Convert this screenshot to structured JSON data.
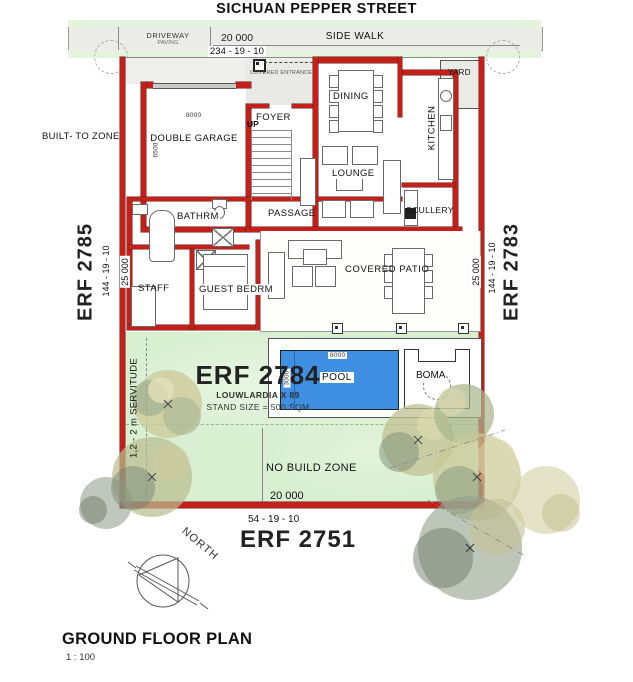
{
  "street": {
    "name": "SICHUAN PEPPER STREET"
  },
  "top_band": {
    "driveway": "DRIVEWAY",
    "driveway_sub": "PAVING",
    "sidewalk": "SIDE WALK",
    "width_dim": "20 000",
    "bearing": "234 - 19 - 10",
    "covered_entrance": "COVERED ENTRANCE"
  },
  "left": {
    "built_to_zone": "BUILT- TO ZONE",
    "erf": "ERF 2785",
    "bearing": "144 - 19 - 10",
    "dim": "25 000"
  },
  "right": {
    "erf": "ERF 2783",
    "bearing": "144 - 19 - 10",
    "dim": "25 000",
    "yard": "YARD"
  },
  "bottom": {
    "erf": "ERF 2751",
    "bearing": "54 - 19 - 10",
    "dim": "20 000"
  },
  "stand": {
    "erf": "ERF 2784",
    "township": "LOUWLARDIA X 89",
    "size": "STAND SIZE = 500 SQM",
    "servitude": "1,2 - 2 m SERVITUDE",
    "no_build_zone": "NO BUILD ZONE"
  },
  "rooms": {
    "garage": {
      "label": "DOUBLE GARAGE",
      "dim_w": "8000",
      "dim_h": "6500"
    },
    "foyer": {
      "label": "FOYER"
    },
    "stairs": {
      "label": "UP"
    },
    "dining": {
      "label": "DINING"
    },
    "kitchen": {
      "label": "KITCHEN"
    },
    "lounge": {
      "label": "LOUNGE"
    },
    "passage": {
      "label": "PASSAGE"
    },
    "scullery": {
      "label": "SCULLERY"
    },
    "bathroom": {
      "label": "BATHRM"
    },
    "guest_bedroom": {
      "label": "GUEST BEDRM"
    },
    "staff": {
      "label": "STAFF"
    },
    "patio": {
      "label": "COVERED PATIO"
    },
    "pool": {
      "label": "POOL",
      "dim_l": "8000",
      "dim_w": "3000"
    },
    "boma": {
      "label": "BOMA"
    }
  },
  "compass": {
    "label": "NORTH"
  },
  "footer": {
    "title": "GROUND FLOOR PLAN",
    "scale": "1 : 100"
  },
  "colors": {
    "wall_red": "#c42019",
    "pool_blue": "#3e8ee2",
    "garden_green": "#d9efd2",
    "street_green": "#e4f3dc",
    "paving_gray": "#ebebe8"
  }
}
